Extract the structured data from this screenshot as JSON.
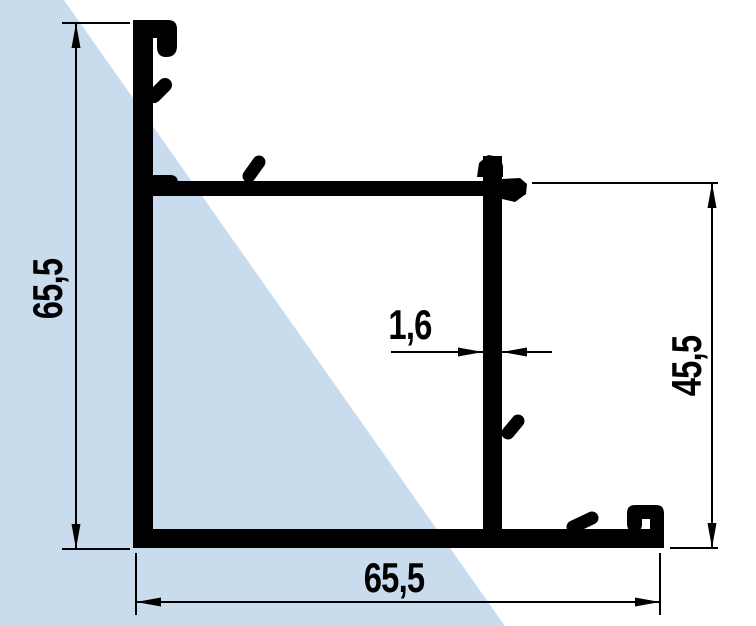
{
  "drawing": {
    "type": "aluminium-profile-cross-section",
    "dimensions": {
      "height_left": "65,5",
      "width_bottom": "65,5",
      "height_right": "45,5",
      "wall_thickness": "1,6"
    },
    "colors": {
      "profile": "#000000",
      "glass_fill": "#c8dcee",
      "background": "#ffffff"
    }
  }
}
